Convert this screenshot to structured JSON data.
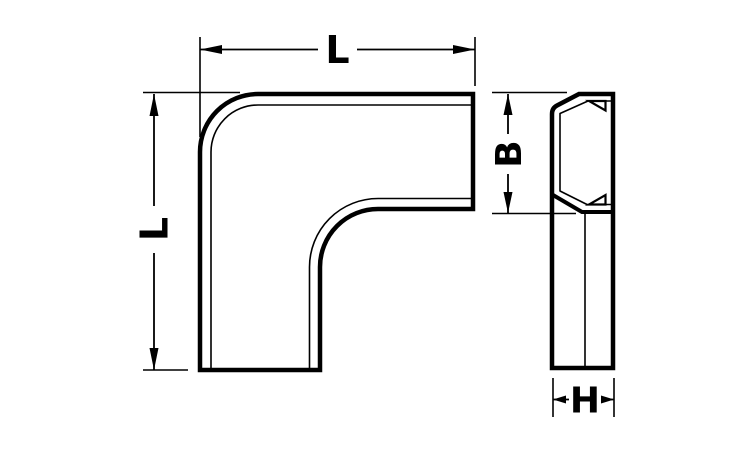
{
  "figure": {
    "type": "technical-dimension-drawing",
    "subject": "flat-elbow duct fitting, front view and side profile view",
    "background_color": "#ffffff",
    "line_color": "#000000",
    "dimensions": {
      "length_top": {
        "label": "L"
      },
      "length_left": {
        "label": "L"
      },
      "height_side": {
        "label": "B"
      },
      "width_side": {
        "label": "H"
      }
    }
  }
}
